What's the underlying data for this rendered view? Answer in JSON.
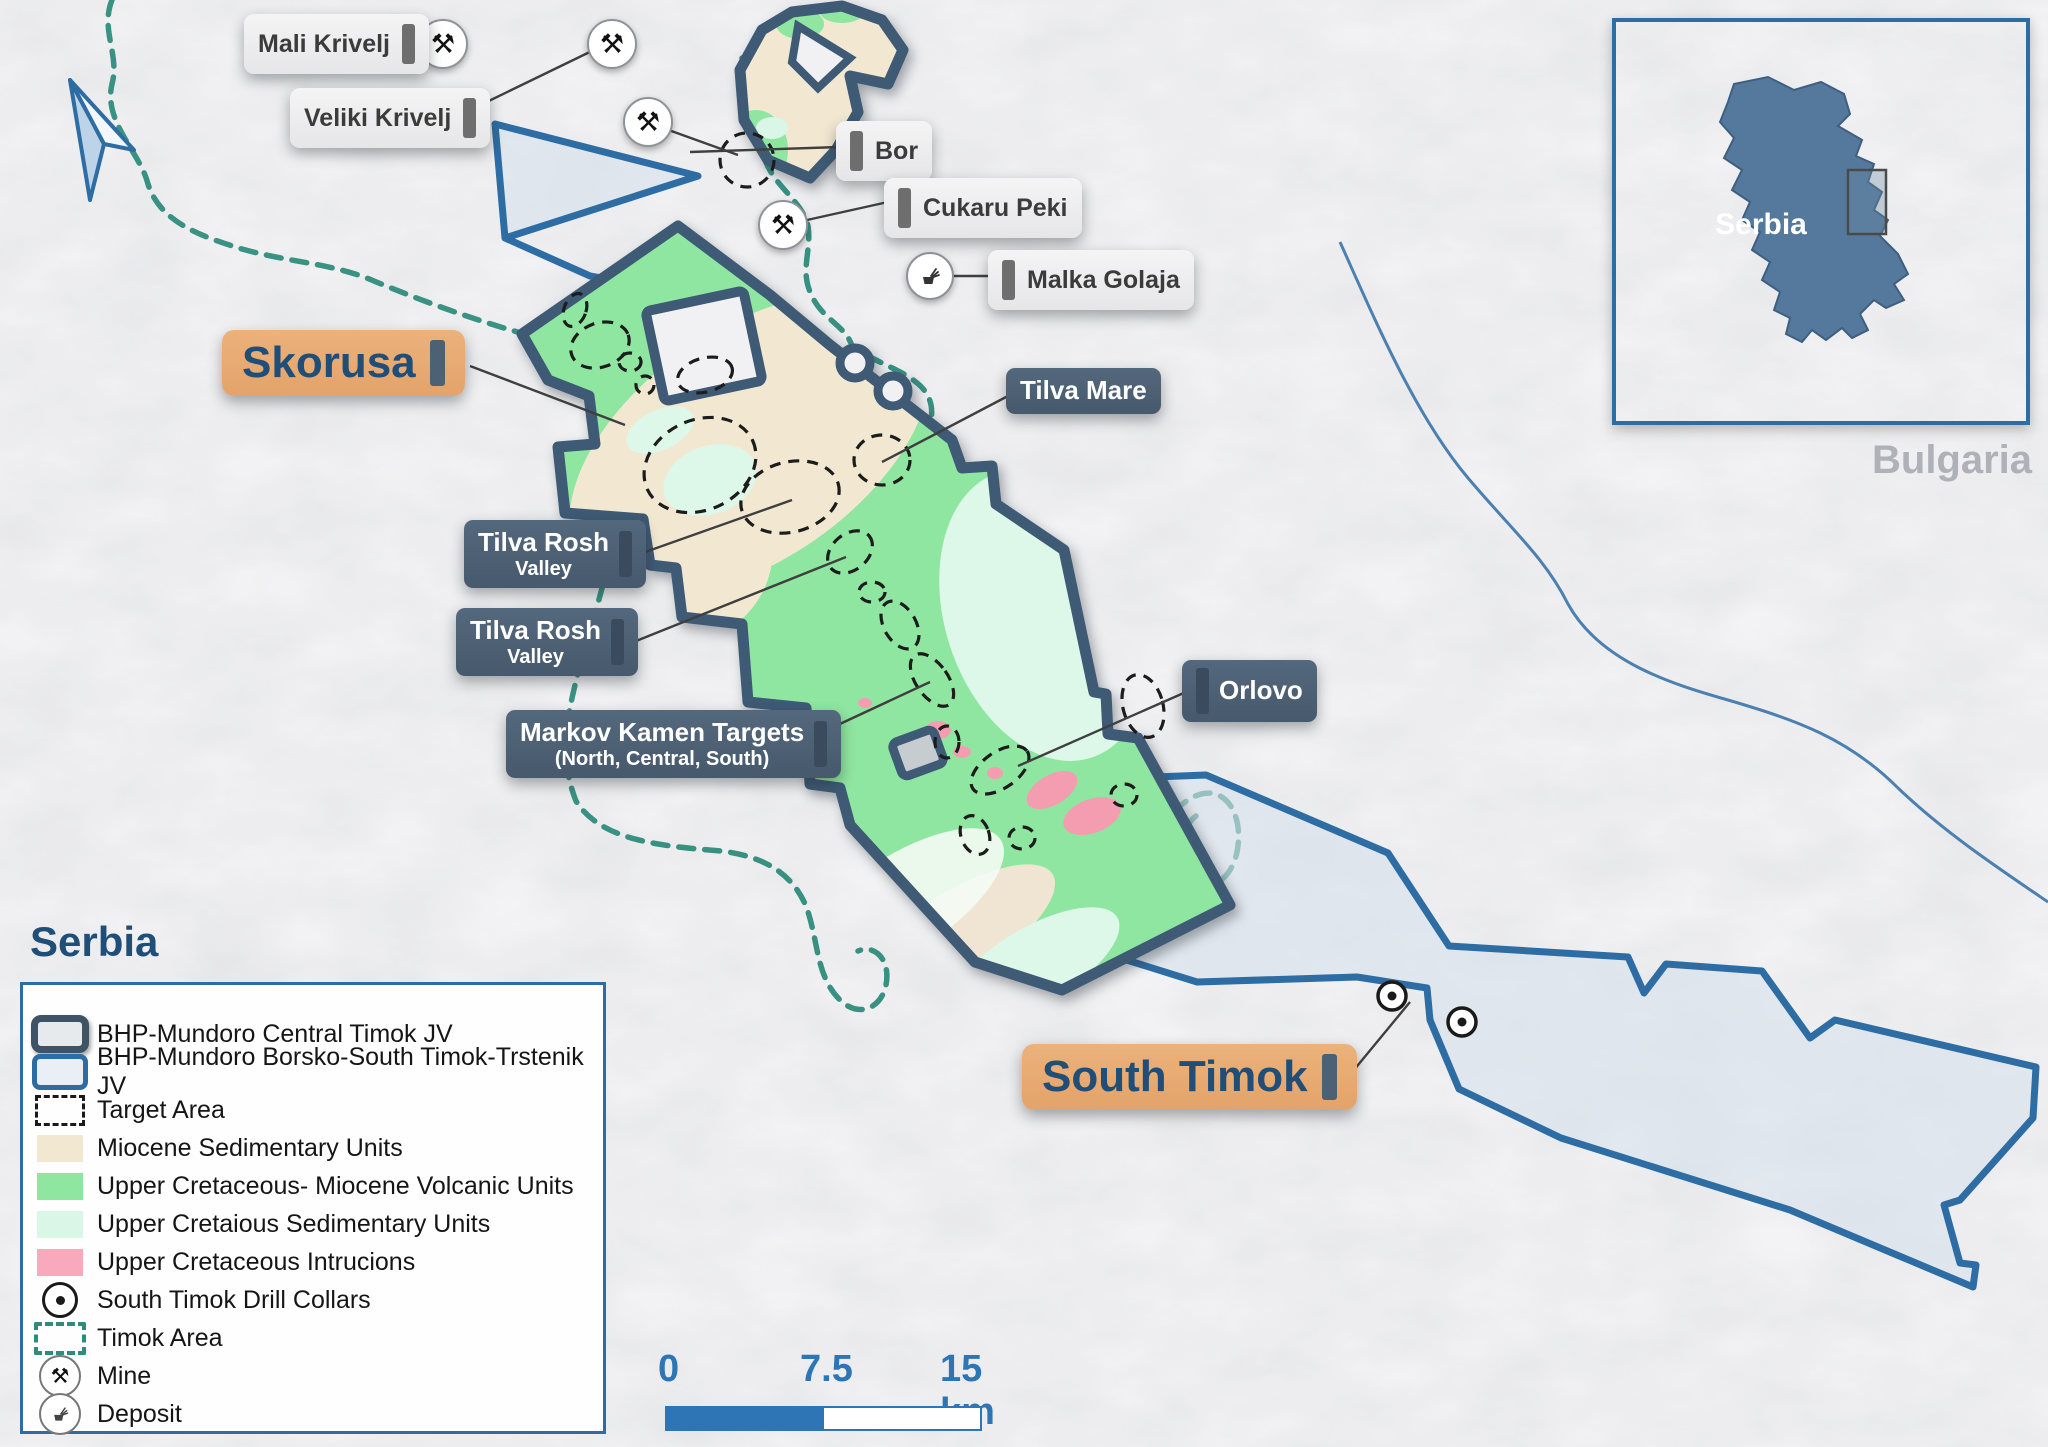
{
  "map": {
    "country_label": "Serbia",
    "neighbor_label": "Bulgaria"
  },
  "inset": {
    "country_label": "Serbia"
  },
  "callouts": {
    "mali_krivelj": {
      "text": "Mali Krivelj"
    },
    "veliki_krivelj": {
      "text": "Veliki Krivelj"
    },
    "bor": {
      "text": "Bor"
    },
    "cukaru_peki": {
      "text": "Cukaru Peki"
    },
    "malka_golaja": {
      "text": "Malka Golaja"
    },
    "skorusa": {
      "text": "Skorusa"
    },
    "tilva_mare": {
      "text": "Tilva Mare"
    },
    "tilva_rosh_valley_1": {
      "text": "Tilva Rosh",
      "subtext": "Valley"
    },
    "tilva_rosh_valley_2": {
      "text": "Tilva Rosh",
      "subtext": "Valley"
    },
    "markov_kamen": {
      "text": "Markov Kamen Targets",
      "subtext": "(North, Central, South)"
    },
    "orlovo": {
      "text": "Orlovo"
    },
    "south_timok": {
      "text": "South Timok"
    }
  },
  "legend": {
    "items": [
      {
        "id": "central-timok-jv",
        "label": "BHP-Mundoro Central Timok JV",
        "symbol": "navy-outline-box",
        "color": "#3E5A75"
      },
      {
        "id": "borsko-jv",
        "label": "BHP-Mundoro Borsko-South Timok-Trstenik JV",
        "symbol": "blue-outline-box",
        "color": "#2E6DA4"
      },
      {
        "id": "target-area",
        "label": "Target Area",
        "symbol": "black-dashed-box",
        "color": "#1A1A1A"
      },
      {
        "id": "miocene-sedimentary",
        "label": "Miocene Sedimentary Units",
        "symbol": "color-swatch",
        "color": "#F2E8D2"
      },
      {
        "id": "uc-miocene-volcanic",
        "label": "Upper Cretaceous- Miocene Volcanic Units",
        "symbol": "color-swatch",
        "color": "#8FE6A0"
      },
      {
        "id": "uc-sedimentary",
        "label": "Upper Cretaious Sedimentary Units",
        "symbol": "color-swatch",
        "color": "#D9F6E6"
      },
      {
        "id": "uc-intrusions",
        "label": "Upper Cretaceous Intrucions",
        "symbol": "color-swatch",
        "color": "#F8A9BC"
      },
      {
        "id": "drill-collars",
        "label": "South Timok Drill Collars",
        "symbol": "circle-dot",
        "color": "#1A1A1A"
      },
      {
        "id": "timok-area",
        "label": "Timok Area",
        "symbol": "teal-dashed-box",
        "color": "#2F8C7C"
      },
      {
        "id": "mine",
        "label": "Mine",
        "symbol": "mine-icon",
        "glyph": "⚒"
      },
      {
        "id": "deposit",
        "label": "Deposit",
        "symbol": "deposit-icon",
        "glyph": "core-stack-shape"
      }
    ]
  },
  "scalebar": {
    "start": "0",
    "mid": "7.5",
    "end": "15 km"
  },
  "icons": {
    "mine_glyph": "⚒"
  },
  "colors": {
    "jv_central_outline": "#3E5A75",
    "jv_borsko_outline": "#2E6DA4",
    "jv_borsko_fill": "#D7E1EB",
    "volcanic_green": "#8FE6A0",
    "sedimentary_mint": "#D9F6E6",
    "miocene_tan": "#F2E8D2",
    "intrusion_pink": "#F8A9BC",
    "timok_area_teal": "#2F8C7C",
    "callout_slate": "#4D6175",
    "callout_orange": "#E7AC74",
    "scalebar_blue": "#2E75B6",
    "inset_country_fill": "#54799D",
    "heading_blue": "#1F4E79"
  }
}
